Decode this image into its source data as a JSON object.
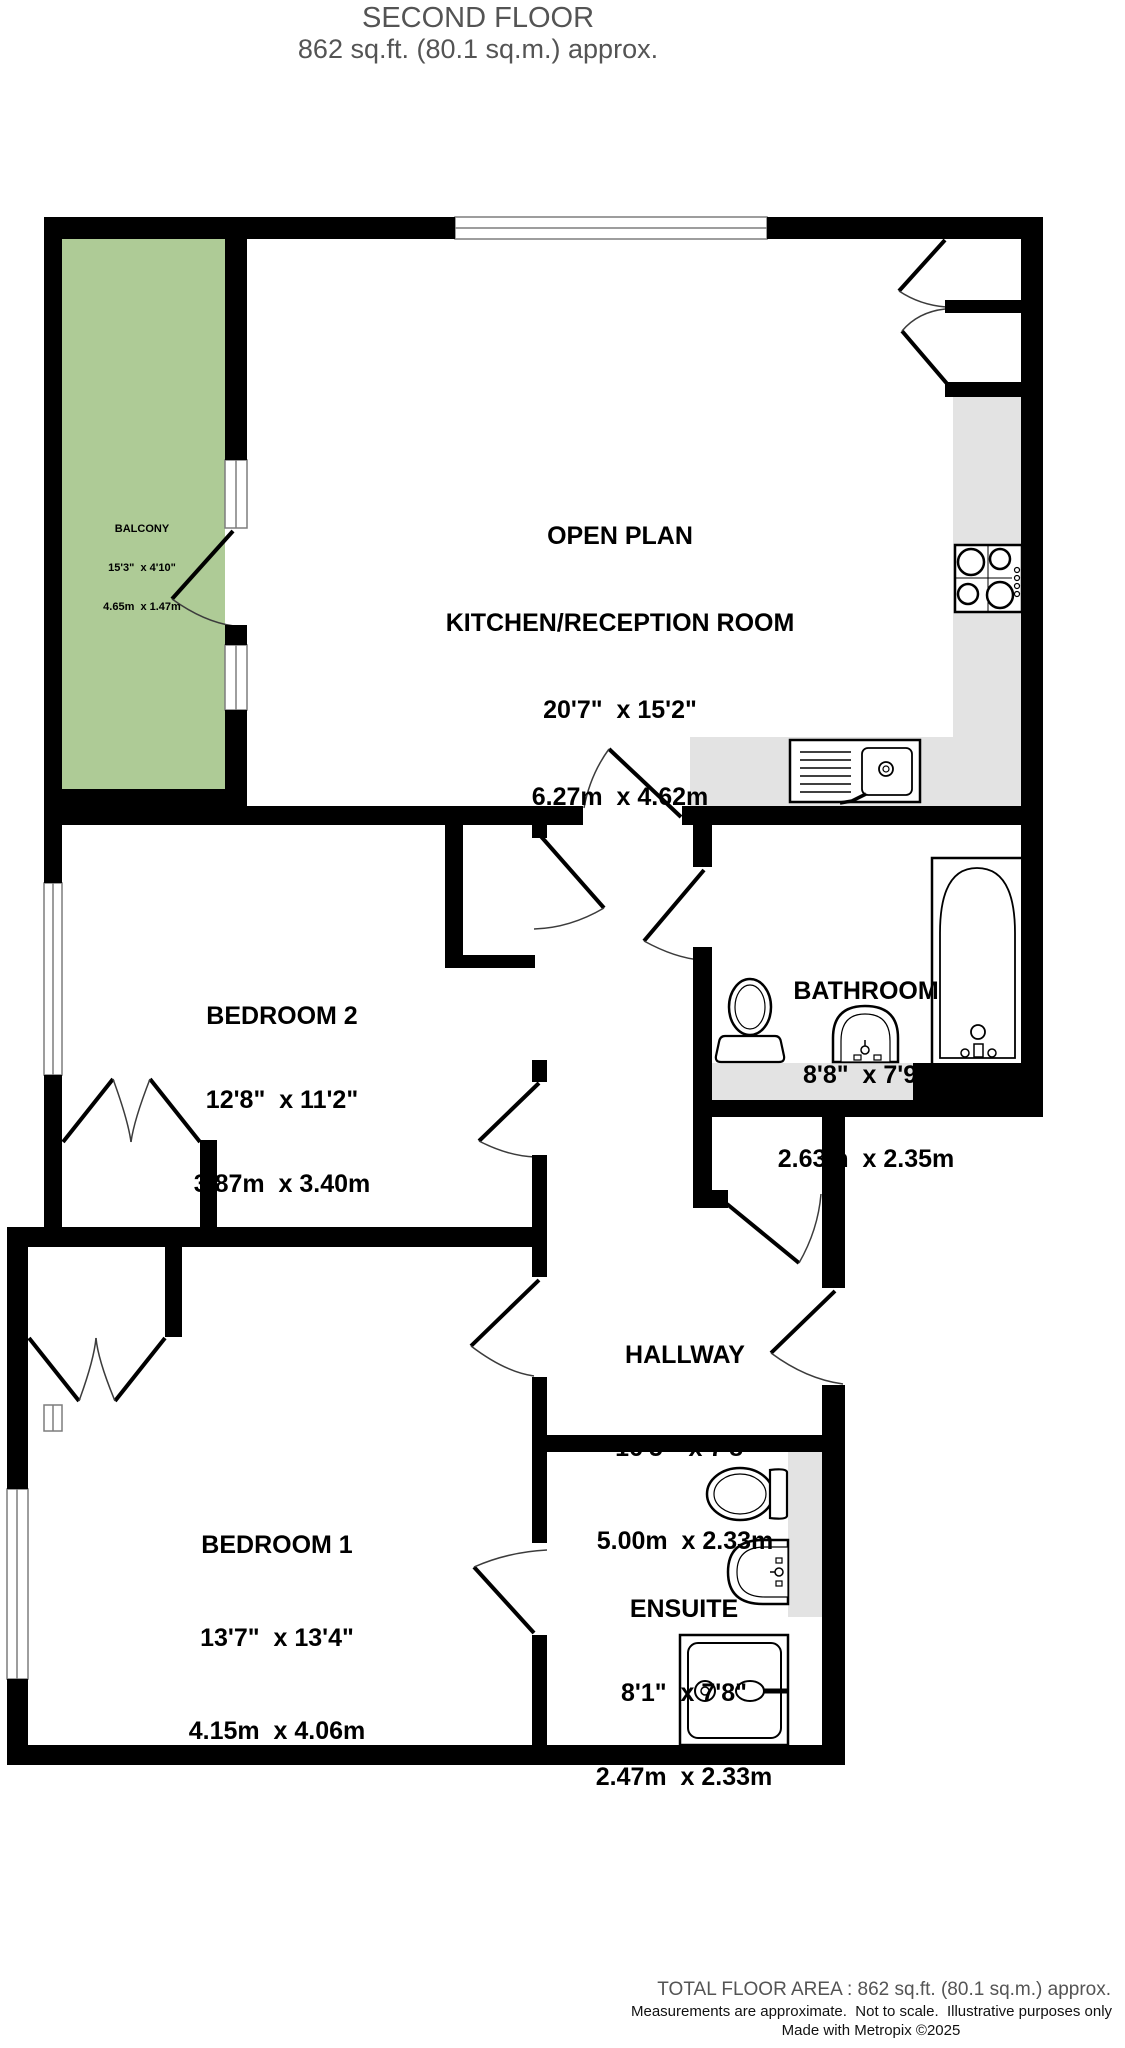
{
  "title": {
    "line1": "SECOND FLOOR",
    "line2": "862 sq.ft. (80.1 sq.m.) approx."
  },
  "rooms": {
    "kitchen": {
      "line1": "OPEN PLAN",
      "line2": "KITCHEN/RECEPTION ROOM",
      "imperial": "20'7\"  x 15'2\"",
      "metric": "6.27m  x 4.62m"
    },
    "balcony": {
      "name": "BALCONY",
      "imperial": "15'3\"  x 4'10\"",
      "metric": "4.65m  x 1.47m"
    },
    "bedroom2": {
      "name": "BEDROOM 2",
      "imperial": "12'8\"  x 11'2\"",
      "metric": "3.87m  x 3.40m"
    },
    "bathroom": {
      "name": "BATHROOM",
      "imperial": "8'8\"  x 7'9\"",
      "metric": "2.63m  x 2.35m"
    },
    "hallway": {
      "name": "HALLWAY",
      "imperial": "16'5\"  x 7'8\"",
      "metric": "5.00m  x 2.33m"
    },
    "bedroom1": {
      "name": "BEDROOM 1",
      "imperial": "13'7\"  x 13'4\"",
      "metric": "4.15m  x 4.06m"
    },
    "ensuite": {
      "name": "ENSUITE",
      "imperial": "8'1\"  x 7'8\"",
      "metric": "2.47m  x 2.33m"
    },
    "storage1": {
      "name": "STORAGE"
    },
    "storage2": {
      "name": "STORAGE"
    },
    "cupboard1": {
      "name": "CUPBOARD"
    },
    "cupboard2": {
      "name": "CUPBOARD"
    },
    "wardrobe1": {
      "name": "WARDROBE"
    },
    "wardrobe2": {
      "name": "WARDROBE"
    }
  },
  "footer": {
    "area": "TOTAL FLOOR AREA : 862 sq.ft. (80.1 sq.m.) approx.",
    "disclaimer": "Measurements are approximate.  Not to scale.  Illustrative purposes only",
    "credit": "Made with Metropix ©2025"
  },
  "colors": {
    "wall": "#000000",
    "balcony_green": "#aecb96",
    "counter_gray": "#e3e3e3",
    "title_gray": "#545454"
  }
}
